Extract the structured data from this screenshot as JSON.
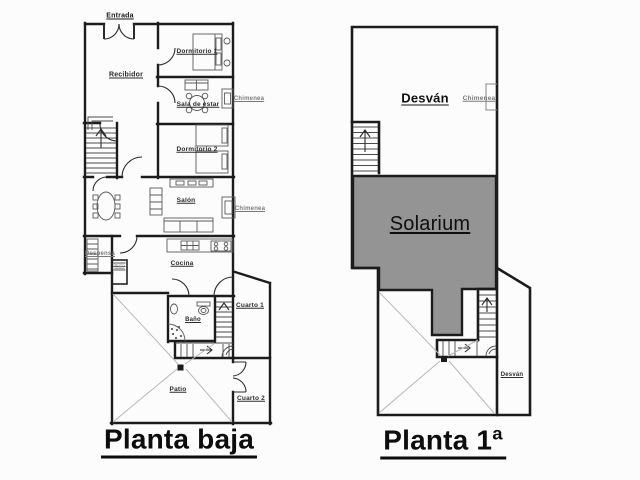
{
  "ground_floor": {
    "title": "Planta baja",
    "rooms": {
      "entrada": "Entrada",
      "recibidor": "Recibidor",
      "dormitorio_1": "Dormitorio 1",
      "sala_de_estar": "Sala de estar",
      "chimenea_sala": "Chimenea",
      "dormitorio_2": "Dormitorio 2",
      "salon": "Salón",
      "chimenea_salon": "Chimenea",
      "despensa": "Despensa",
      "pozo": "Pozo",
      "cocina": "Cocina",
      "bano": "Baño",
      "cuarto_1": "Cuarto 1",
      "patio": "Patio",
      "cuarto_2": "Cuarto 2"
    }
  },
  "first_floor": {
    "title": "Planta 1ª",
    "rooms": {
      "desvan": "Desván",
      "chimenea": "Chimenea",
      "solarium": "Solarium",
      "desvan_corridor": "Desván"
    }
  },
  "colors": {
    "wall": "#1c1c1c",
    "solarium_fill": "#949494",
    "patio_diagonal": "#b8b8b8"
  }
}
